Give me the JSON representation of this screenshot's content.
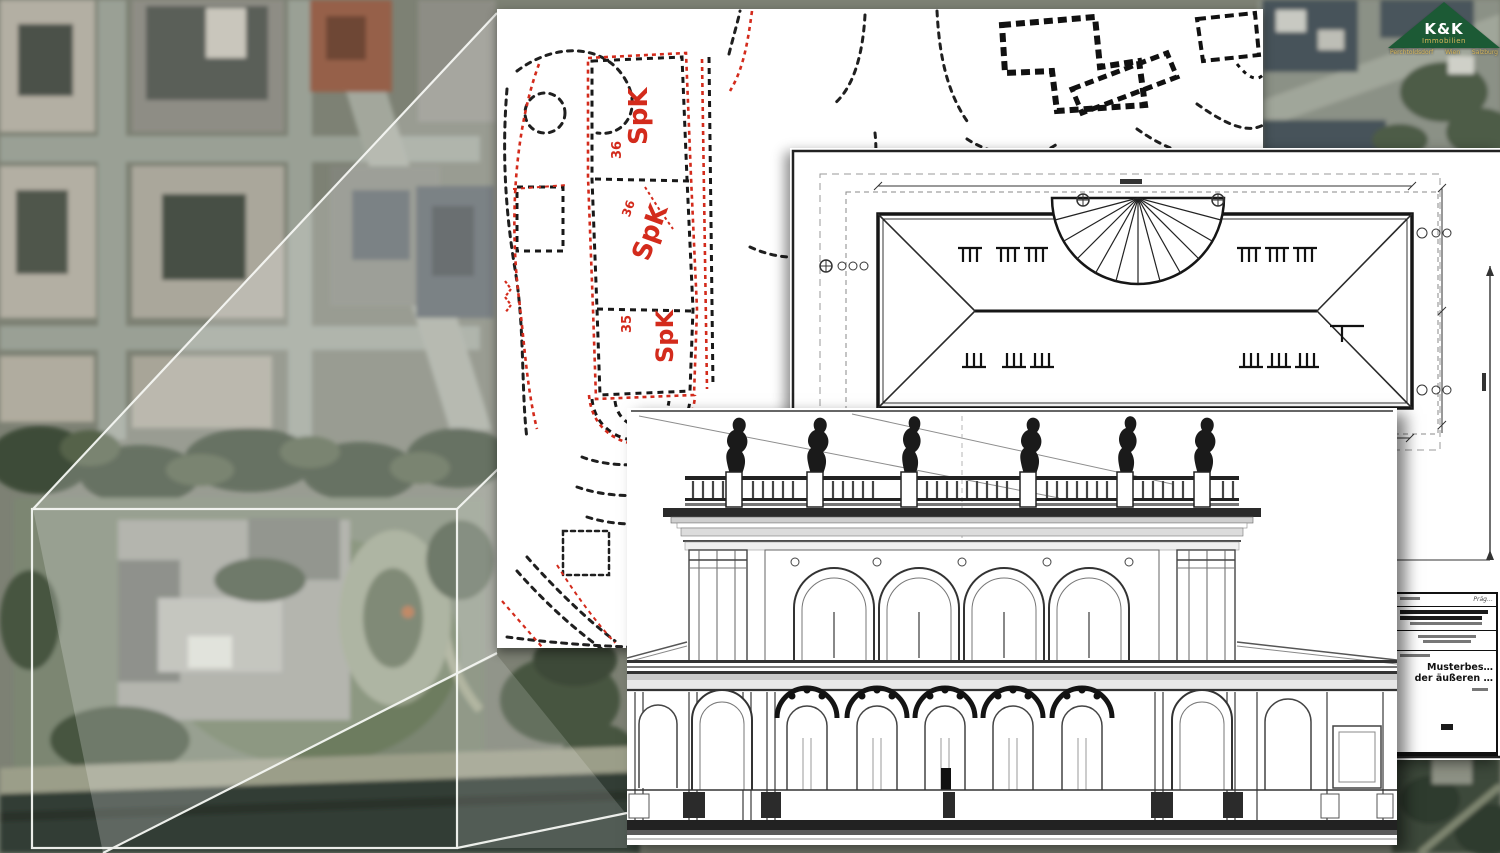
{
  "logo": {
    "brand": "K&K",
    "subtitle": "Immobilien",
    "tagline": [
      "Perchtoldsdorf",
      "Wien",
      "Salzburg"
    ]
  },
  "palette": {
    "ink": "#1d1d1d",
    "red": "#d32b1c",
    "paper": "#ffffff",
    "green": "#1c5a35",
    "gold": "#d9b85a",
    "wire": "#f5f7f3"
  },
  "map": {
    "type": "aerial-photo",
    "callout": {
      "rect": {
        "x": 32,
        "y": 509,
        "w": 425,
        "h": 339
      },
      "connector_color": "#f5f7f3"
    }
  },
  "sheets": {
    "site_plan": {
      "kind": "cadastral site plan with red survey markings",
      "rooms": [
        {
          "label": "SpK",
          "number": "36"
        },
        {
          "label": "SpK",
          "number": "36"
        },
        {
          "label": "SpK",
          "number": "35"
        }
      ]
    },
    "roof_plan": {
      "kind": "roof plan (Dachdraufsicht) with dimension lines",
      "title_block": {
        "line1": "Musterbes…",
        "line2": "der äußeren …"
      }
    },
    "elevation": {
      "kind": "front facade elevation with balustrade statues",
      "statue_count": 6
    }
  }
}
